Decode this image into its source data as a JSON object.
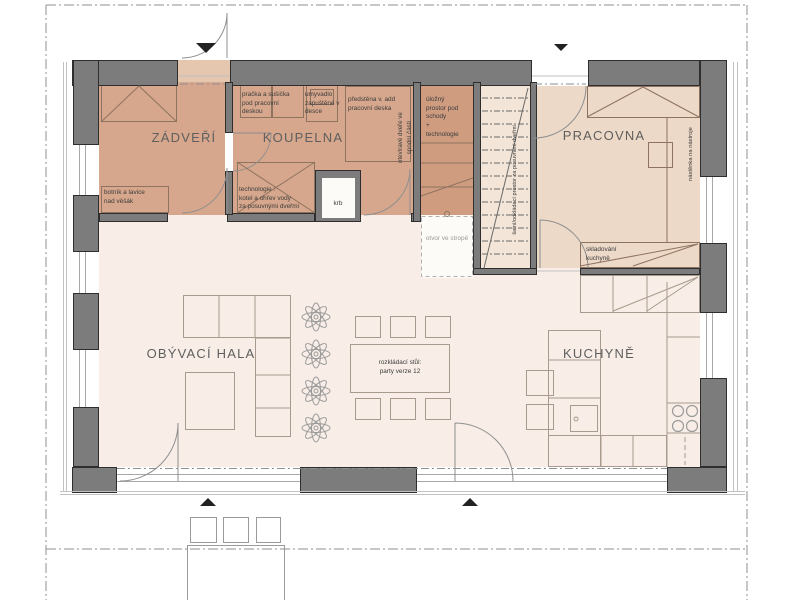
{
  "title": "rodinný dům – půdorys přízemí",
  "colors": {
    "wall_fill": "#7c7c7c",
    "wall_stroke": "#2e2e2e",
    "entry_bath_floor": "#d6a78c",
    "storage_floor": "#cf9c80",
    "study_floor": "#edd9c7",
    "stairs_floor": "#f3e5d7",
    "living_floor": "#f8eee7",
    "ceiling_opening_floor": "#fdfbf8",
    "line_gray": "#8f8f8f",
    "furniture_line": "#a89a8c",
    "marker_black": "#222222"
  },
  "rooms": {
    "zadveri": "ZÁDVEŘÍ",
    "koupelna": "KOUPELNA",
    "pracovna": "PRACOVNA",
    "hala": "OBÝVACÍ HALA",
    "kuchyne": "KUCHYNĚ"
  },
  "labels": {
    "pracka": "pračka a sušička\npod pracovní\ndeskou",
    "umyvadlo": "umyvadlo\nzapuštěné v\ndesce",
    "predstena": "předstěna v. add\npracovní deska",
    "otevirave": "otevíravé dveře ve\nspodní části",
    "ulozny": "úložný\nprostor pod\nschody\n+\ntechnologie",
    "botnik": "botník a lavice\nnad věšák",
    "technologie": "technologie :\nkotel a ohřev vody\nza posuvnými dveřmi",
    "krb": "krb",
    "otvor": "otvor ve stropě",
    "satni": "šatní/odkládací prostor za posuvními dveřmi",
    "nastenka": "nástěnka na nástroje",
    "skladovani": "skladování\nkuchyně",
    "stul": "rozkládací stůl:\nparty verze 12"
  }
}
